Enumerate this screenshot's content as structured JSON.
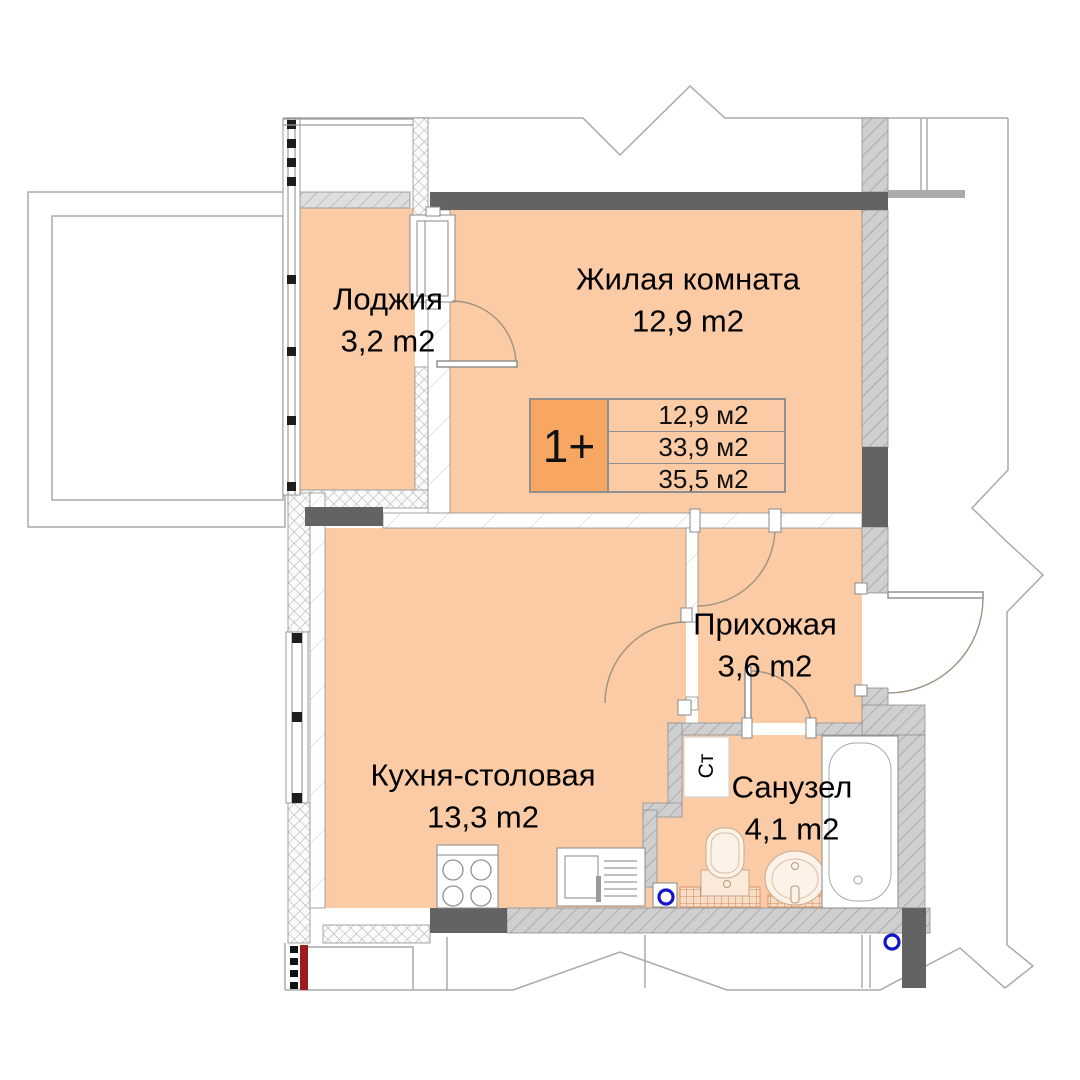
{
  "plan": {
    "title": "apartment-floor-plan",
    "rooms": [
      {
        "id": "loggia",
        "name": "Лоджия",
        "area": "3,2 m2"
      },
      {
        "id": "living",
        "name": "Жилая комната",
        "area": "12,9 m2"
      },
      {
        "id": "kitchen",
        "name": "Кухня-столовая",
        "area": "13,3 m2"
      },
      {
        "id": "hallway",
        "name": "Прихожая",
        "area": "3,6 m2"
      },
      {
        "id": "bathroom",
        "name": "Санузел",
        "area": "4,1 m2"
      }
    ],
    "legend": {
      "unit_type": "1+",
      "rows": [
        "12,9 м2",
        "33,9 м2",
        "35,5 м2"
      ]
    },
    "labels": {
      "washer": "Ст"
    },
    "colors": {
      "floor": "#fbcba5",
      "legend_accent": "#f8a763",
      "wall_dark": "#636363",
      "wall_gray": "#cfcfcf",
      "plumbing_blue": "#1414cc",
      "riser_red": "#9e1b1b"
    }
  }
}
